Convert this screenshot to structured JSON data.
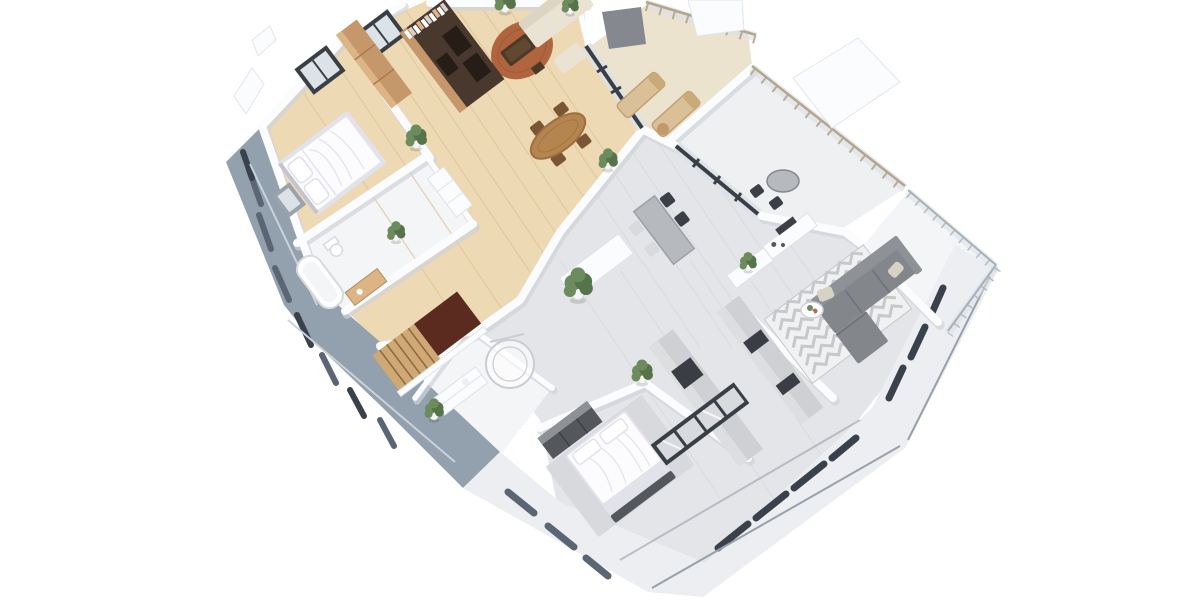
{
  "meta": {
    "description": "Isometric 3D floor plan rendering of a two-unit apartment floor with terraces and balconies on a white background",
    "view": "3d-isometric-floor-plan",
    "background": "#ffffff",
    "image_size": {
      "width": 1200,
      "height": 600
    }
  },
  "palette": {
    "bg": "#ffffff",
    "woodFloor": "#edd9b4",
    "woodStreak": "#e1c79c",
    "tileFloor": "#e4e5e8",
    "tileStreak": "#d8d9dd",
    "terraceTile": "#ece3cf",
    "terraceLight": "#eff0f2",
    "bathFloor": "#f4f5f7",
    "balconyFloor": "#f4f5f7",
    "wallWhite": "#fbfcfe",
    "wallShadow": "#d0d3d9",
    "facadeBlue": "#93a0ad",
    "facadeSlot": "#5b6674",
    "facadeSlotDark": "#39414d",
    "facadeLight": "#edeef1",
    "facadeLightSlot": "#9aa0a9",
    "facadeLedge": "#c9d2da",
    "frameDark": "#3a3e45",
    "glassTint": "#dbe2e8",
    "oak": "#c6976a",
    "oakLight": "#ddb486",
    "espresso": "#49382e",
    "espressoDark": "#261d17",
    "terracotta": "#b0653f",
    "ctableBrown": "#4c3929",
    "tableWood": "#b5854f",
    "chairWood": "#7a5634",
    "beigeSofa": "#eae3d4",
    "beigeSofaBack": "#ddd5c3",
    "sofaGray": "#83868b",
    "sofaGrayBack": "#8e9196",
    "pillowBeige": "#d8d2c6",
    "rugChevBase": "#f1f1f2",
    "rugChevLine": "#c5c8cc",
    "bedWhite": "#fcfcfe",
    "bedShadow": "#e2e2ea",
    "rugGray": "#d8d9dc",
    "darkFurn": "#54575c",
    "plantGreen": "#6d8c5e",
    "plantDark": "#55744a",
    "potWhite": "#f6f6f6",
    "stairWood": "#cfa873",
    "stairwell": "#5a2b1e",
    "stairLine": "#8a6a42",
    "railTan": "#b5a58c",
    "railMetal": "#a9afb6",
    "counterGray": "#ced0d4",
    "counterTop": "#dcdee0",
    "counterDark": "#3a3d43",
    "tableGray": "#b6b9be",
    "chairDark": "#3c3f45",
    "chairLight": "#d8dadd",
    "screenGray": "#85898f"
  },
  "rooms": [
    {
      "id": "bedroom-1",
      "floor": "wood"
    },
    {
      "id": "bathroom-1",
      "floor": "white-tile"
    },
    {
      "id": "kitchen-living-1",
      "floor": "wood"
    },
    {
      "id": "dining-1",
      "floor": "wood"
    },
    {
      "id": "stair-hall",
      "floor": "wood"
    },
    {
      "id": "shower-room",
      "floor": "white-tile"
    },
    {
      "id": "kitchen-dining-2",
      "floor": "gray-tile"
    },
    {
      "id": "living-2",
      "floor": "gray-tile"
    },
    {
      "id": "bedroom-2",
      "floor": "gray-tile"
    },
    {
      "id": "terrace-1",
      "floor": "beige-tile"
    },
    {
      "id": "terrace-2",
      "floor": "light-tile"
    },
    {
      "id": "balcony",
      "floor": "light-tile"
    }
  ],
  "furniture": [
    "double-bed-1",
    "tan-wardrobe",
    "espresso-media-shelf",
    "round-terracotta-rug",
    "dark-coffee-table",
    "beige-sofa",
    "oval-dining-table",
    "dining-chairs",
    "bathtub",
    "toilet",
    "tan-vanity",
    "staircase",
    "shower-enclosure",
    "shower-vanity",
    "kitchen-island",
    "gray-dining-table",
    "tv-console",
    "chevron-rug",
    "gray-sectional-sofa",
    "flower-side-table",
    "kitchen-counters",
    "hall-cabinet",
    "double-bed-2",
    "gray-rug",
    "dark-dresser",
    "glass-wardrobe",
    "round-terrace-table",
    "terrace-chairs",
    "sun-loungers",
    "potted-plants"
  ]
}
